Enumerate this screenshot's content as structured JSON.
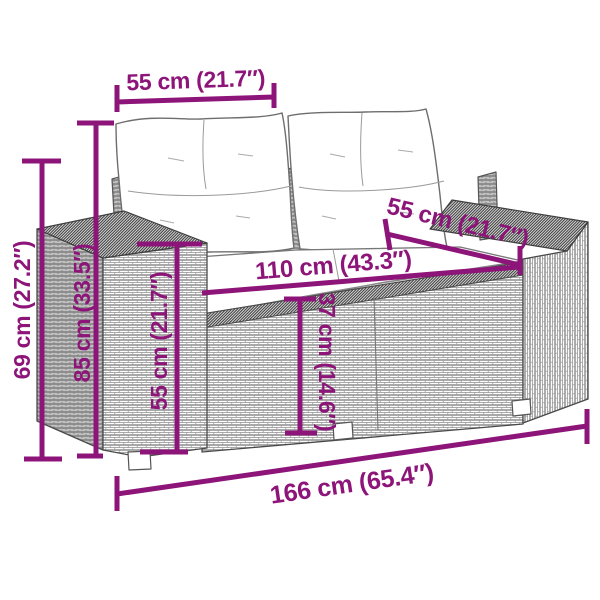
{
  "diagram": {
    "description": "Dimension diagram of a 2-seater poly rattan garden sofa with cushions",
    "colors": {
      "dimension_accent": "#8d1478",
      "line_art": "#4a4a4a",
      "cushion_fill": "#ffffff"
    },
    "labels": {
      "backrest_width": "55 cm (21.7″)",
      "total_height": "69 cm (27.2″)",
      "backrest_height": "85 cm (33.5″)",
      "armrest_height": "55 cm (21.7″)",
      "seat_width": "110 cm (43.3″)",
      "seat_depth": "55 cm (21.7″)",
      "seat_height": "37 cm (14.6″)",
      "total_width": "166 cm (65.4″)"
    }
  }
}
